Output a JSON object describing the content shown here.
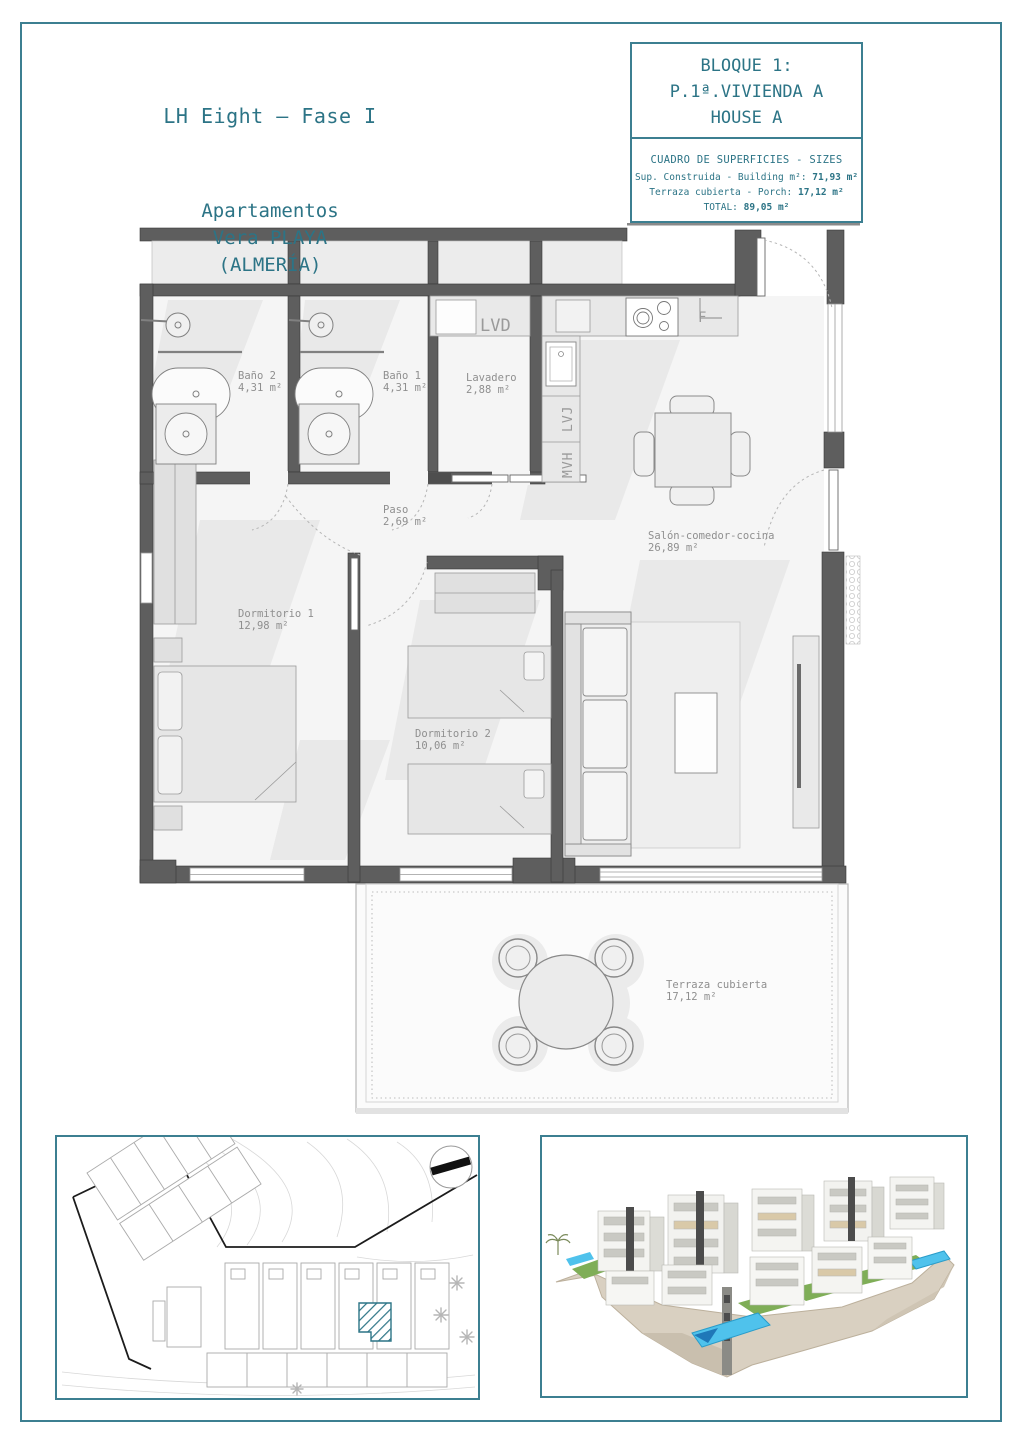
{
  "page": {
    "project_title": "LH Eight – Fase I",
    "location_lines": [
      "Apartamentos",
      "Vera PLAYA",
      "(ALMERÍA)"
    ]
  },
  "title_block": {
    "line1": "BLOQUE 1:",
    "line2": "P.1ª.VIVIENDA A",
    "line3": "HOUSE A",
    "table_title": "CUADRO DE SUPERFICIES - SIZES",
    "rows": [
      {
        "label": "Sup. Construida - Building m²:",
        "value": "71,93 m²"
      },
      {
        "label": "Terraza cubierta - Porch:",
        "value": "17,12 m²"
      },
      {
        "label": "TOTAL:",
        "value": "89,05 m²"
      }
    ]
  },
  "floor_plan": {
    "rooms": [
      {
        "name": "Baño 2",
        "area": "4,31 m²"
      },
      {
        "name": "Baño 1",
        "area": "4,31 m²"
      },
      {
        "name": "Lavadero",
        "area": "2,88 m²"
      },
      {
        "name": "Paso",
        "area": "2,69 m²"
      },
      {
        "name": "Salón-comedor-cocina",
        "area": "26,89 m²"
      },
      {
        "name": "Dormitorio 1",
        "area": "12,98 m²"
      },
      {
        "name": "Dormitorio 2",
        "area": "10,06 m²"
      },
      {
        "name": "Terraza cubierta",
        "area": "17,12 m²"
      }
    ],
    "appliances": [
      "LVD",
      "LVJ",
      "MVH",
      "F"
    ]
  },
  "colors": {
    "accent_teal": "#2c7486",
    "frame_teal": "#3c7f91",
    "wall_gray": "#5e5e5e",
    "label_gray": "#8f8f8f",
    "unit_marker_hatch": "#2c7486",
    "pool_blue": "#4fc2ec",
    "lawn_green": "#7fae57",
    "stone_tan": "#d9d0c1"
  }
}
